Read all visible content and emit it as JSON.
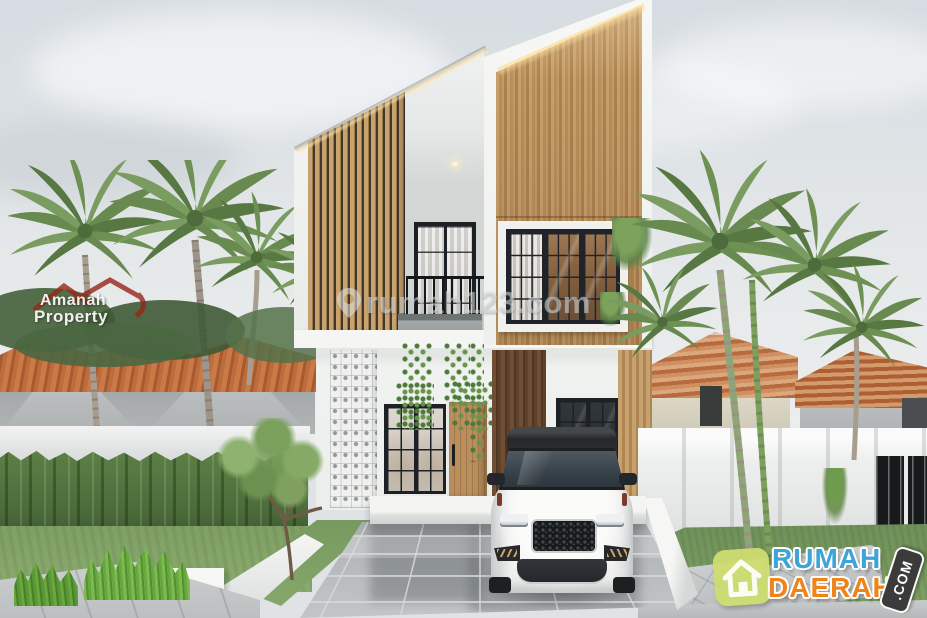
{
  "scene": {
    "type": "architectural-3d-render",
    "subject": "Modern minimalist two-story house with wood-panel facade and white SUV parked in tiled driveway",
    "setting": "Residential neighborhood with palm trees, orange-tile-roof neighbor houses, white perimeter walls, hedge and lawn"
  },
  "palette": {
    "sky": "#dde2e5",
    "house_white": "#f3f4f2",
    "wood_panel": "#bb905c",
    "wood_dark": "#5f4029",
    "window_frame": "#1d2125",
    "neighbor_roof_orange": "#b76a3e",
    "hedge_green": "#4c6c3a",
    "lawn_green": "#7fa064",
    "palm_green": "#6d9053",
    "driveway_gray": "#b4b8ba",
    "car_white": "#f6f6f5",
    "car_roof_black": "#26282a"
  },
  "watermarks": {
    "amanah": {
      "line1": "Amanah",
      "line2": "Property",
      "text_color": "#ffffff",
      "roof_color": "#97271a",
      "icon": "home-roof-icon"
    },
    "rumah123": {
      "text": "rumah123.com",
      "icon": "location-pin-icon",
      "color": "#e6e9ea"
    },
    "rumah_daerah": {
      "word_top": "RUMAH",
      "word_bottom": "DAERAH",
      "suffix": ".COM",
      "icon": "house-icon",
      "colors": {
        "word_top": "#3da4d8",
        "word_bottom": "#ef8418",
        "icon_bg": "#cedc70",
        "suffix_bg": "#3b3b3b",
        "suffix_text": "#ffffff"
      }
    }
  }
}
